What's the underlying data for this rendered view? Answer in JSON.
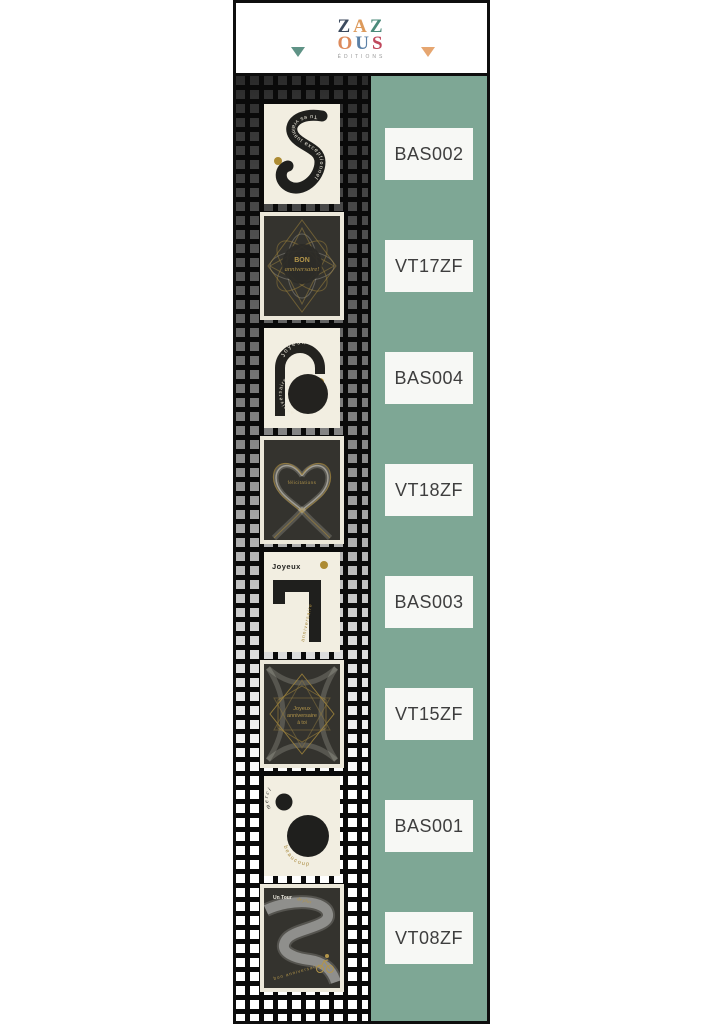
{
  "header": {
    "logo": {
      "chars": [
        "Z",
        "A",
        "Z",
        "O",
        "U",
        "S"
      ],
      "subtext": "ÉDITIONS",
      "letter_colors": [
        "#3c4a5e",
        "#dd9a5b",
        "#4b8a7a",
        "#dd8a5b",
        "#5b80a6",
        "#c0485c"
      ]
    },
    "left_triangle_color": "#5f9386",
    "right_triangle_color": "#e6a670"
  },
  "colors": {
    "column_green": "#7ea795",
    "pattern_black": "#0a0a0a",
    "card_cream": "#f2eee1",
    "card_dark": "#34332e",
    "gold_accent": "#a8893c",
    "label_background": "#f7f8f5",
    "label_text": "#3e3e3e"
  },
  "labels": [
    "BAS002",
    "VT17ZF",
    "BAS004",
    "VT18ZF",
    "BAS003",
    "VT15ZF",
    "BAS001",
    "VT08ZF"
  ],
  "cards": [
    {
      "code": "BAS002",
      "style": "cream",
      "path_text": "Tu es vraiment exceptionnel"
    },
    {
      "code": "VT17ZF",
      "style": "dark",
      "line1": "BON",
      "line2": "anniversaire!"
    },
    {
      "code": "BAS004",
      "style": "cream",
      "arch_text": "Joyeux",
      "circle_text": "anniversaire"
    },
    {
      "code": "VT18ZF",
      "style": "dark",
      "center_text": "félicitations"
    },
    {
      "code": "BAS003",
      "style": "cream",
      "top_text": "Joyeux",
      "side_text": "anniversaire"
    },
    {
      "code": "VT15ZF",
      "style": "dark",
      "line1": "Joyeux",
      "line2": "anniversaire",
      "line3": "à toi"
    },
    {
      "code": "BAS001",
      "style": "cream",
      "arc_text_1": "merci",
      "arc_text_2": "beaucoup"
    },
    {
      "code": "VT08ZF",
      "style": "dark",
      "top_text_1": "Un Tour",
      "top_text_2": "de plus",
      "bottom_text": "bon anniversaire"
    }
  ]
}
